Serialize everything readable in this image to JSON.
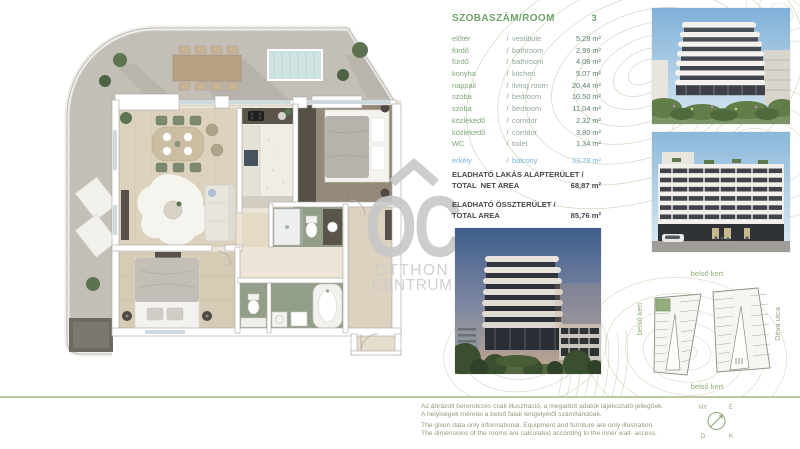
{
  "room_table": {
    "title": "SZOBASZÁM/ROOM",
    "room_count": "3",
    "separator": "/",
    "rows": [
      {
        "hu": "előtér",
        "en": "vestibule",
        "area": "5,28 m²"
      },
      {
        "hu": "fürdő",
        "en": "bathroom",
        "area": "2,99 m²"
      },
      {
        "hu": "fürdő",
        "en": "bathroom",
        "area": "4,08 m²"
      },
      {
        "hu": "konyha",
        "en": "kitchen",
        "area": "5,07 m²"
      },
      {
        "hu": "nappali",
        "en": "living room",
        "area": "20,44 m²"
      },
      {
        "hu": "szoba",
        "en": "bedroom",
        "area": "10,50 m²"
      },
      {
        "hu": "szoba",
        "en": "bedroom",
        "area": "11,04 m²"
      },
      {
        "hu": "közlekedő",
        "en": "corridor",
        "area": "2,32 m²"
      },
      {
        "hu": "közlekedő",
        "en": "corridor",
        "area": "3,80 m²"
      },
      {
        "hu": "WC",
        "en": "toilet",
        "area": "1,34 m²"
      }
    ],
    "balcony_row": {
      "hu": "erkély",
      "en": "balcony",
      "area": "33,78 m²"
    }
  },
  "net_area": {
    "label_hu": "ELADHATÓ LAKÁS ALAPTERÜLET /",
    "label_en": "TOTAL  NET AREA",
    "value": "68,87 m²"
  },
  "total_area": {
    "label_hu": "ELADHATÓ ÖSSZTERÜLET /",
    "label_en": "TOTAL AREA",
    "value": "85,76 m²"
  },
  "watermark": {
    "glyph": "OC",
    "line1": "OTTHON",
    "line2": "CENTRUM"
  },
  "site_plan": {
    "garden_top": "belső kert",
    "garden_left": "belső kert",
    "garden_bottom": "belső kert",
    "street": "Déva utca"
  },
  "compass": {
    "top_left": "NY",
    "top_right": "É",
    "bottom_left": "D",
    "bottom_right": "K"
  },
  "disclaimer": {
    "hu1": "Az ábrázolt berendezés csak illusztráció, a megadott adatok tájékoztató jellegűek.",
    "hu2": "A helyiségek méretei a belső falak tengelyétől számítandóak.",
    "en1": "The given data only informational. Equipment and furniture are only illustration.",
    "en2": "The dimensions of the rooms are calculated according to the inner wall- access."
  },
  "colors": {
    "accent_green": "#6fa36d",
    "value_green": "#5d7f68",
    "balcony_blue": "#74b7d6",
    "dark_text": "#45494a",
    "divider_green": "#b6c9a2",
    "contour_olive": "#ccd1b6",
    "contour_tan": "#dcd3bb",
    "watermark_gray": "#c7c7c7",
    "highlight_unit_green": "#93ad7d"
  }
}
